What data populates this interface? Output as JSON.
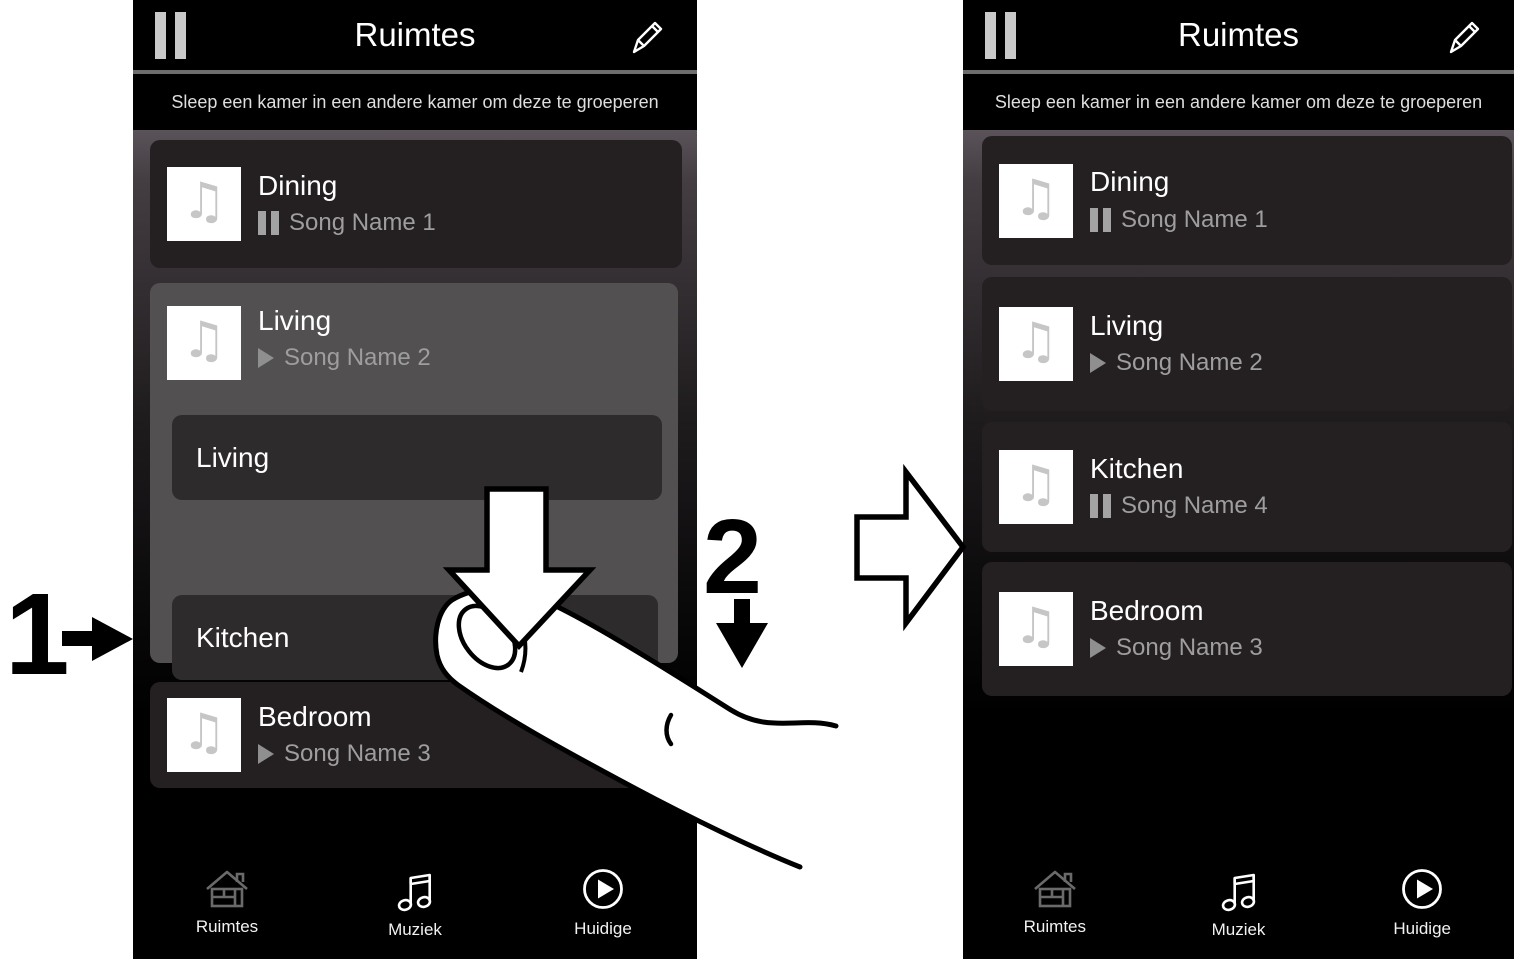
{
  "annotations": {
    "step_1": "1",
    "step_2": "2",
    "finger": "finger-pointer-illustration",
    "drag_arrow": "drag-down-arrow",
    "transition_arrow": "right-block-arrow"
  },
  "icons": {
    "thumbnail_glyph": "♫",
    "header_left": "pause-icon",
    "header_right": "edit-pencil-icon",
    "tab_rooms": "home-icon",
    "tab_music": "music-note-icon",
    "tab_now_playing": "play-circle-icon"
  },
  "phone_left": {
    "header": {
      "title": "Ruimtes"
    },
    "hint": "Sleep een kamer in een andere kamer om deze te groeperen",
    "rooms": [
      {
        "name": "Dining",
        "song": "Song Name 1",
        "state": "paused"
      },
      {
        "name": "Living",
        "song": "Song Name 2",
        "state": "playing",
        "expanded": true,
        "drop_zone_label": "Living",
        "dragged_room_label": "Kitchen"
      },
      {
        "name": "Bedroom",
        "song": "Song Name 3",
        "state": "playing"
      }
    ],
    "tabs": [
      {
        "label": "Ruimtes",
        "icon": "home-icon"
      },
      {
        "label": "Muziek",
        "icon": "music-note-icon"
      },
      {
        "label": "Huidige",
        "icon": "play-circle-icon"
      }
    ]
  },
  "phone_right": {
    "header": {
      "title": "Ruimtes"
    },
    "hint": "Sleep een kamer in een andere kamer om deze te groeperen",
    "rooms": [
      {
        "name": "Dining",
        "song": "Song Name 1",
        "state": "paused"
      },
      {
        "name": "Living",
        "song": "Song Name 2",
        "state": "playing"
      },
      {
        "name": "Kitchen",
        "song": "Song Name 4",
        "state": "paused"
      },
      {
        "name": "Bedroom",
        "song": "Song Name 3",
        "state": "playing"
      }
    ],
    "tabs": [
      {
        "label": "Ruimtes",
        "icon": "home-icon"
      },
      {
        "label": "Muziek",
        "icon": "music-note-icon"
      },
      {
        "label": "Huidige",
        "icon": "play-circle-icon"
      }
    ]
  },
  "colors": {
    "card_dark": "#242021",
    "card_highlight": "#525051",
    "inner_row": "#2e2b2c",
    "thumbnail_note": "#c6c6c6",
    "song_text": "#9e9e9e",
    "header_pause_bars": "#c9c9c9",
    "tab_home_icon": "#6a6a6a"
  }
}
